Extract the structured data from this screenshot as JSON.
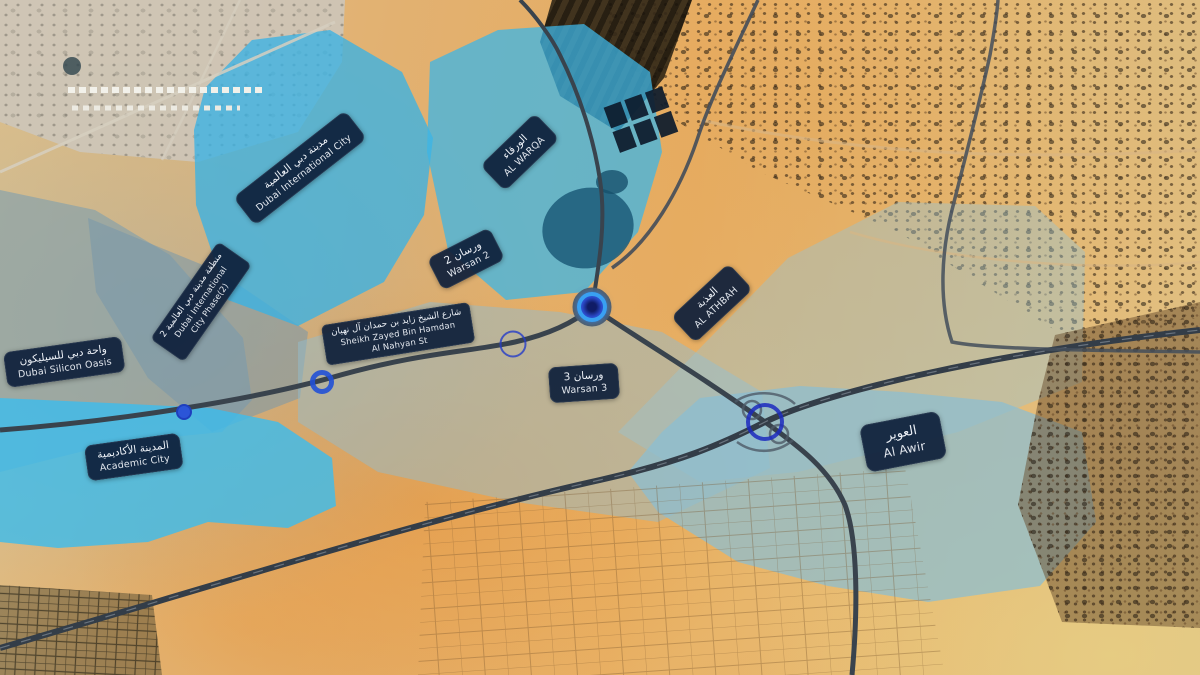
{
  "map": {
    "palette": {
      "marker_blue": "#2b55d8",
      "marker_ring_highlight": "#39a0f2",
      "label_background": "#0e1f3a",
      "label_text": "#eef2f8",
      "zone_cyan": "#45b9e6",
      "zone_pale_blue": "#a9c9d6",
      "desert_sand": "#e3b06a",
      "road_dark": "#39434d"
    },
    "zones": [
      {
        "id": "silicon-oasis-west",
        "color": "rgba(125,158,175,0.60)"
      },
      {
        "id": "international-city-phase2",
        "color": "rgba(118,152,172,0.55)"
      },
      {
        "id": "international-city",
        "color": "rgba(58,178,228,0.78)"
      },
      {
        "id": "al-warqa",
        "color": "rgba(62,182,230,0.75)"
      },
      {
        "id": "academic-city",
        "color": "rgba(62,188,235,0.82)"
      },
      {
        "id": "athbah-plain",
        "color": "rgba(148,188,203,0.50)"
      },
      {
        "id": "right-diagonal-band",
        "color": "rgba(150,195,212,0.42)"
      },
      {
        "id": "al-awir",
        "color": "rgba(138,190,210,0.72)"
      }
    ],
    "labels": [
      {
        "id": "dubai-international-city",
        "x": 300,
        "y": 168,
        "rot": -38,
        "lines": [
          {
            "lang": "ar",
            "t": "مدينة دبي العالمية"
          },
          {
            "lang": "en",
            "t": "Dubai International City"
          }
        ]
      },
      {
        "id": "al-warqa",
        "x": 520,
        "y": 152,
        "rot": -44,
        "lines": [
          {
            "lang": "ar",
            "t": "الورقاء"
          },
          {
            "lang": "en",
            "t": "AL WARQA"
          }
        ]
      },
      {
        "id": "dic-phase-2",
        "x": 201,
        "y": 302,
        "rot": -55,
        "size": "small",
        "lines": [
          {
            "lang": "ar",
            "t": "منطقة مدينة دبي العالمية 2"
          },
          {
            "lang": "en",
            "t": "Dubai International"
          },
          {
            "lang": "en",
            "t": "City Phase(2)"
          }
        ]
      },
      {
        "id": "warsan-2",
        "x": 466,
        "y": 259,
        "rot": -27,
        "lines": [
          {
            "lang": "ar",
            "t": "ورسان 2"
          },
          {
            "lang": "en",
            "t": "Warsan 2"
          }
        ]
      },
      {
        "id": "sheikh-zayed-bin-hamdan-al-nahyan-st",
        "x": 398,
        "y": 334,
        "rot": -9,
        "size": "small",
        "lines": [
          {
            "lang": "ar",
            "t": "شارع الشيخ زايد بن حمدان آل نهيان"
          },
          {
            "lang": "en",
            "t": "Sheikh Zayed Bin Hamdan"
          },
          {
            "lang": "en",
            "t": "Al Nahyan St"
          }
        ]
      },
      {
        "id": "dubai-silicon-oasis",
        "x": 64,
        "y": 362,
        "rot": -8,
        "lines": [
          {
            "lang": "ar",
            "t": "واحة دبي للسيليكون"
          },
          {
            "lang": "en",
            "t": "Dubai Silicon Oasis"
          }
        ]
      },
      {
        "id": "al-athbah",
        "x": 712,
        "y": 303,
        "rot": -43,
        "lines": [
          {
            "lang": "ar",
            "t": "العذبة"
          },
          {
            "lang": "en",
            "t": "AL ATHBAH"
          }
        ]
      },
      {
        "id": "warsan-3",
        "x": 584,
        "y": 383,
        "rot": -4,
        "lines": [
          {
            "lang": "ar",
            "t": "ورسان 3"
          },
          {
            "lang": "en",
            "t": "Warsan 3"
          }
        ]
      },
      {
        "id": "academic-city",
        "x": 134,
        "y": 457,
        "rot": -8,
        "lines": [
          {
            "lang": "ar",
            "t": "المدينة الأكاديمية"
          },
          {
            "lang": "en",
            "t": "Academic City"
          }
        ]
      },
      {
        "id": "al-awir",
        "x": 903,
        "y": 442,
        "rot": -11,
        "size": "big",
        "lines": [
          {
            "lang": "ar",
            "t": "العوير"
          },
          {
            "lang": "en",
            "t": "Al Awir"
          }
        ]
      }
    ],
    "markers": [
      {
        "id": "roundabout-selected",
        "kind": "filled-ring",
        "x": 592,
        "y": 307
      },
      {
        "id": "junction-thin-ring",
        "kind": "thin-ring",
        "x": 513,
        "y": 344
      },
      {
        "id": "road-point-thick-ring",
        "kind": "thick-ring",
        "x": 322,
        "y": 382
      },
      {
        "id": "road-point-dot",
        "kind": "dot",
        "x": 184,
        "y": 412
      },
      {
        "id": "interchange-ring",
        "kind": "ring-x",
        "x": 765,
        "y": 422
      }
    ]
  }
}
